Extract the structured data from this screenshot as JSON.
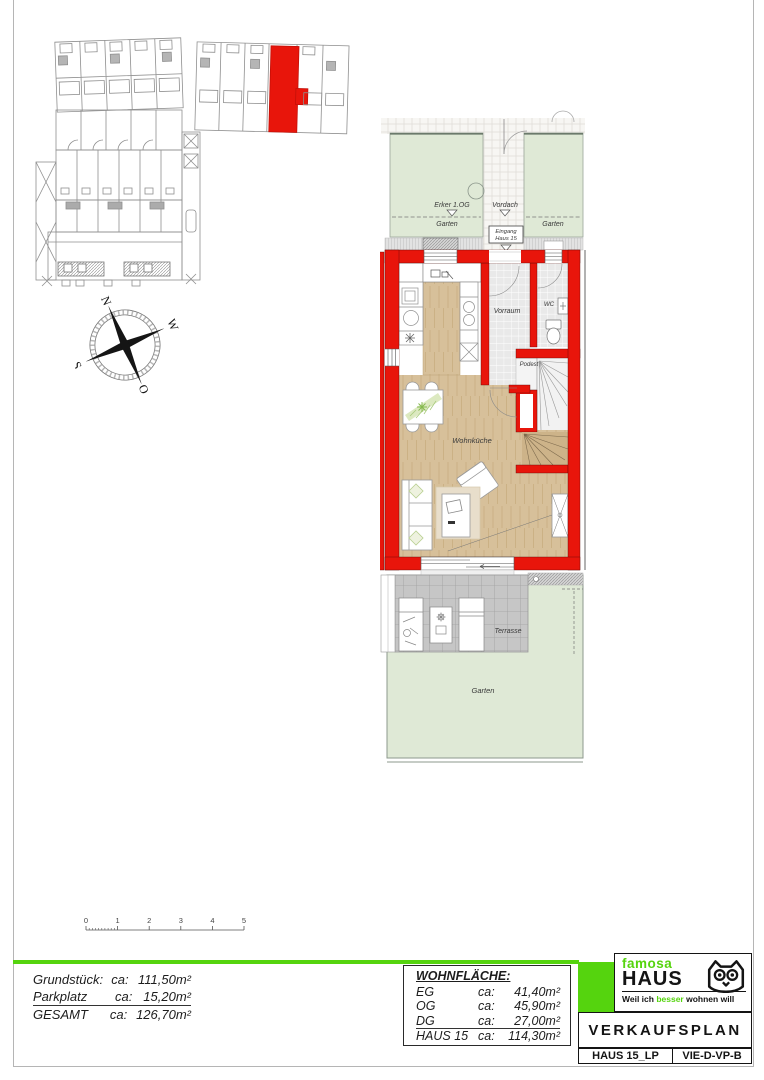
{
  "colors": {
    "accent_green": "#55d40e",
    "wall_red": "#e8150b",
    "wood_floor": "#d7c09a",
    "garden_green": "#dfe9d6",
    "terrace_gray": "#c6c6c6",
    "tile_gray": "#e9e9e9"
  },
  "compass": {
    "west": "W",
    "north": "N",
    "south": "S",
    "east": "O"
  },
  "floor_plan": {
    "erker_label": "Erker 1.OG",
    "vordach_label": "Vordach",
    "garten_top_left": "Garten",
    "garten_top_right": "Garten",
    "eingang_line1": "Eingang",
    "eingang_line2": "Haus 15",
    "vorraum": "Vorraum",
    "wc": "WC",
    "podest": "Podest",
    "wohnkueche": "Wohnküche",
    "terrasse": "Terrasse",
    "garten_bottom": "Garten"
  },
  "scale_bar": {
    "ticks": [
      "0",
      "1",
      "2",
      "3",
      "4",
      "5"
    ]
  },
  "site_summary": {
    "rows": [
      {
        "label": "Grundstück:",
        "ca": "ca:",
        "value": "111,50m²"
      },
      {
        "label": "Parkplatz",
        "ca": "ca:",
        "value": "15,20m²"
      },
      {
        "label": "GESAMT",
        "ca": "ca:",
        "value": "126,70m²"
      }
    ]
  },
  "living_area": {
    "title": "WOHNFLÄCHE:",
    "rows": [
      {
        "label": "EG",
        "ca": "ca:",
        "value": "41,40m²"
      },
      {
        "label": "OG",
        "ca": "ca:",
        "value": "45,90m²"
      },
      {
        "label": "DG",
        "ca": "ca:",
        "value": "27,00m²"
      },
      {
        "label": "HAUS 15",
        "ca": "ca:",
        "value": "114,30m²"
      }
    ]
  },
  "title_block": {
    "brand_top": "famosa",
    "brand_main": "HAUS",
    "tagline_pre": "Weil ich ",
    "tagline_green": "besser",
    "tagline_post": " wohnen will",
    "plan_title": "VERKAUFSPLAN",
    "doc_code_left": "HAUS 15_LP",
    "doc_code_right": "VIE-D-VP-B",
    "logo_icon": "owl-icon"
  }
}
